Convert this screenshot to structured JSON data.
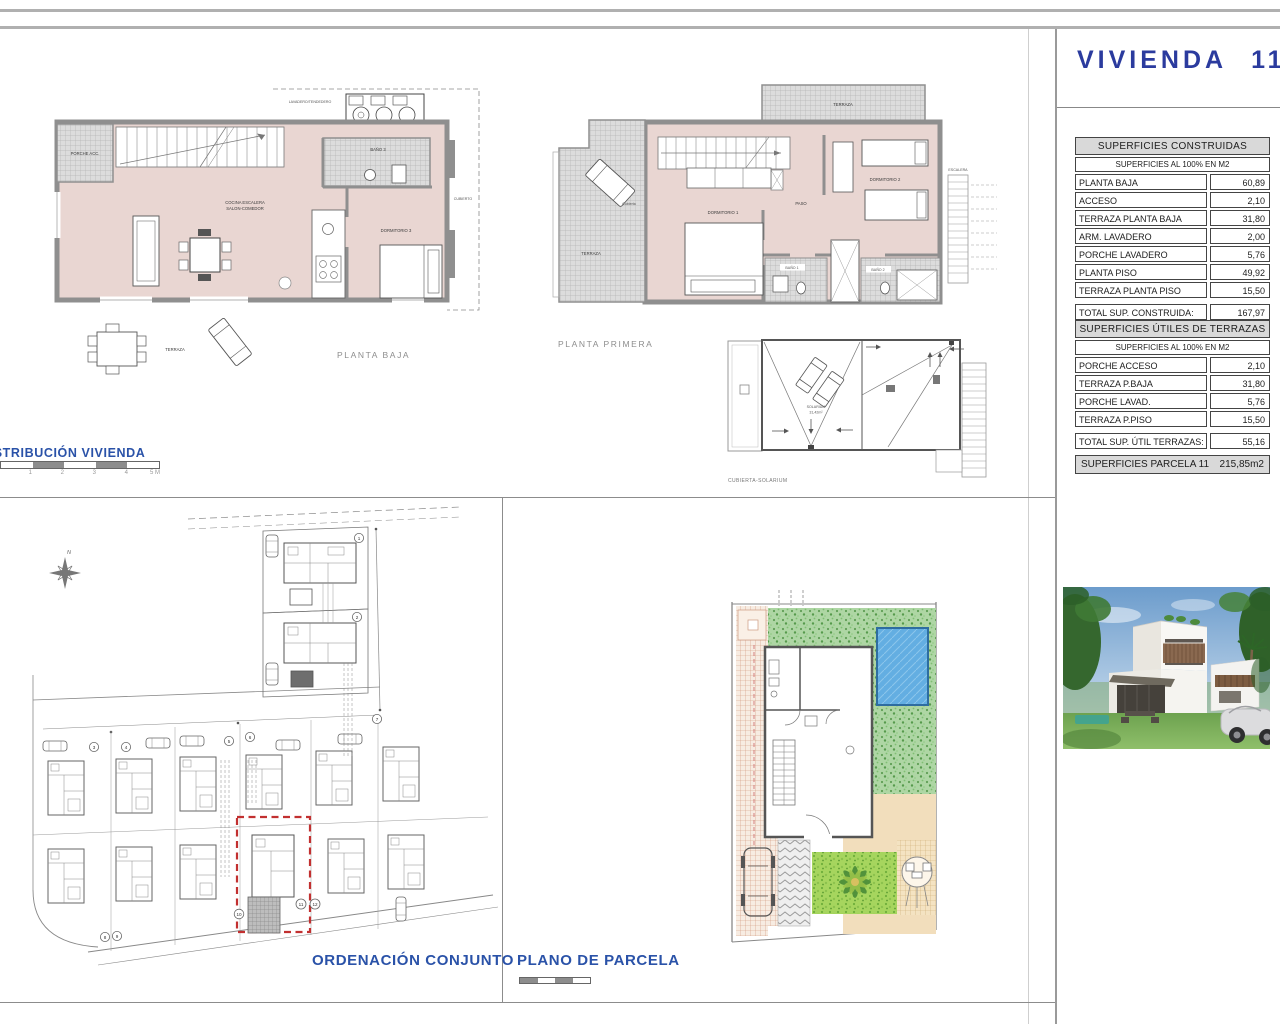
{
  "colors": {
    "accent_blue": "#2b3b9e",
    "section_blue": "#2a52a8",
    "plan_interior_pink": "#e9d6d2",
    "wall_gray": "#8f8f8f",
    "highlight_red": "#c23030",
    "pool_blue": "#63aee2",
    "garden_green": "#aed6a4",
    "terrace_beige": "#f2debc"
  },
  "header": {
    "title": "VIVIENDA 11"
  },
  "plans": {
    "planta_baja": {
      "caption": "PLANTA BAJA",
      "rooms": {
        "lavadero": "LAVADERO/TENDEDERO",
        "porche": "PORCHE ACC.",
        "bano3": "BAÑO 3",
        "cocina1": "COCINA ESCALERA",
        "cocina2": "SALON-COMEDOR",
        "dormitorio3": "DORMITORIO 3",
        "cubierto": "CUBIERTO",
        "terraza": "TERRAZA"
      }
    },
    "planta_primera": {
      "caption": "PLANTA PRIMERA",
      "rooms": {
        "terraza_superior": "TERRAZA",
        "cubierta": "Cubierta",
        "terraza": "TERRAZA",
        "dormitorio1": "DORMITORIO 1",
        "paso": "PASO",
        "dormitorio2": "DORMITORIO 2",
        "bano1": "BAÑO 1",
        "bano2": "BAÑO 2",
        "escalera": "ESCALERA"
      }
    },
    "cubierta_solarium": {
      "caption": "CUBIERTA-SOLARIUM",
      "solarium": "SOLARIUM",
      "solarium_area": "31,42m²"
    }
  },
  "sections": {
    "distribucion_title": "DISTRIBUCIÓN VIVIENDA",
    "ordenacion_title": "ORDENACIÓN CONJUNTO",
    "parcela_title": "PLANO DE PARCELA"
  },
  "scale_bar": {
    "ticks": [
      "1",
      "2",
      "3",
      "4",
      "5 M"
    ]
  },
  "site_plan": {
    "compass_north": "N",
    "plot_numbers": {
      "p1": "1",
      "p2": "2",
      "p3": "3",
      "p4": "4",
      "p5": "5",
      "p6": "6",
      "p7": "7",
      "p8": "8",
      "p9": "9",
      "p10": "10",
      "p11": "11",
      "p12": "12"
    }
  },
  "tables": {
    "construidas": {
      "title": "SUPERFICIES CONSTRUIDAS",
      "subtitle": "SUPERFICIES AL 100% EN M2",
      "rows": [
        {
          "label": "PLANTA BAJA",
          "value": "60,89"
        },
        {
          "label": "ACCESO",
          "value": "2,10"
        },
        {
          "label": "TERRAZA PLANTA BAJA",
          "value": "31,80"
        },
        {
          "label": "ARM. LAVADERO",
          "value": "2,00"
        },
        {
          "label": "PORCHE LAVADERO",
          "value": "5,76"
        },
        {
          "label": "PLANTA PISO",
          "value": "49,92"
        },
        {
          "label": "TERRAZA PLANTA PISO",
          "value": "15,50"
        }
      ],
      "total_label": "TOTAL SUP. CONSTRUIDA:",
      "total_value": "167,97"
    },
    "terrazas": {
      "title": "SUPERFICIES ÚTILES DE TERRAZAS",
      "subtitle": "SUPERFICIES AL 100% EN M2",
      "rows": [
        {
          "label": "PORCHE ACCESO",
          "value": "2,10"
        },
        {
          "label": "TERRAZA P.BAJA",
          "value": "31,80"
        },
        {
          "label": "PORCHE LAVAD.",
          "value": "5,76"
        },
        {
          "label": "TERRAZA P.PISO",
          "value": "15,50"
        }
      ],
      "total_label": "TOTAL SUP. ÚTIL TERRAZAS:",
      "total_value": "55,16"
    },
    "parcela": {
      "label": "SUPERFICIES PARCELA 11",
      "value": "215,85m2"
    }
  }
}
